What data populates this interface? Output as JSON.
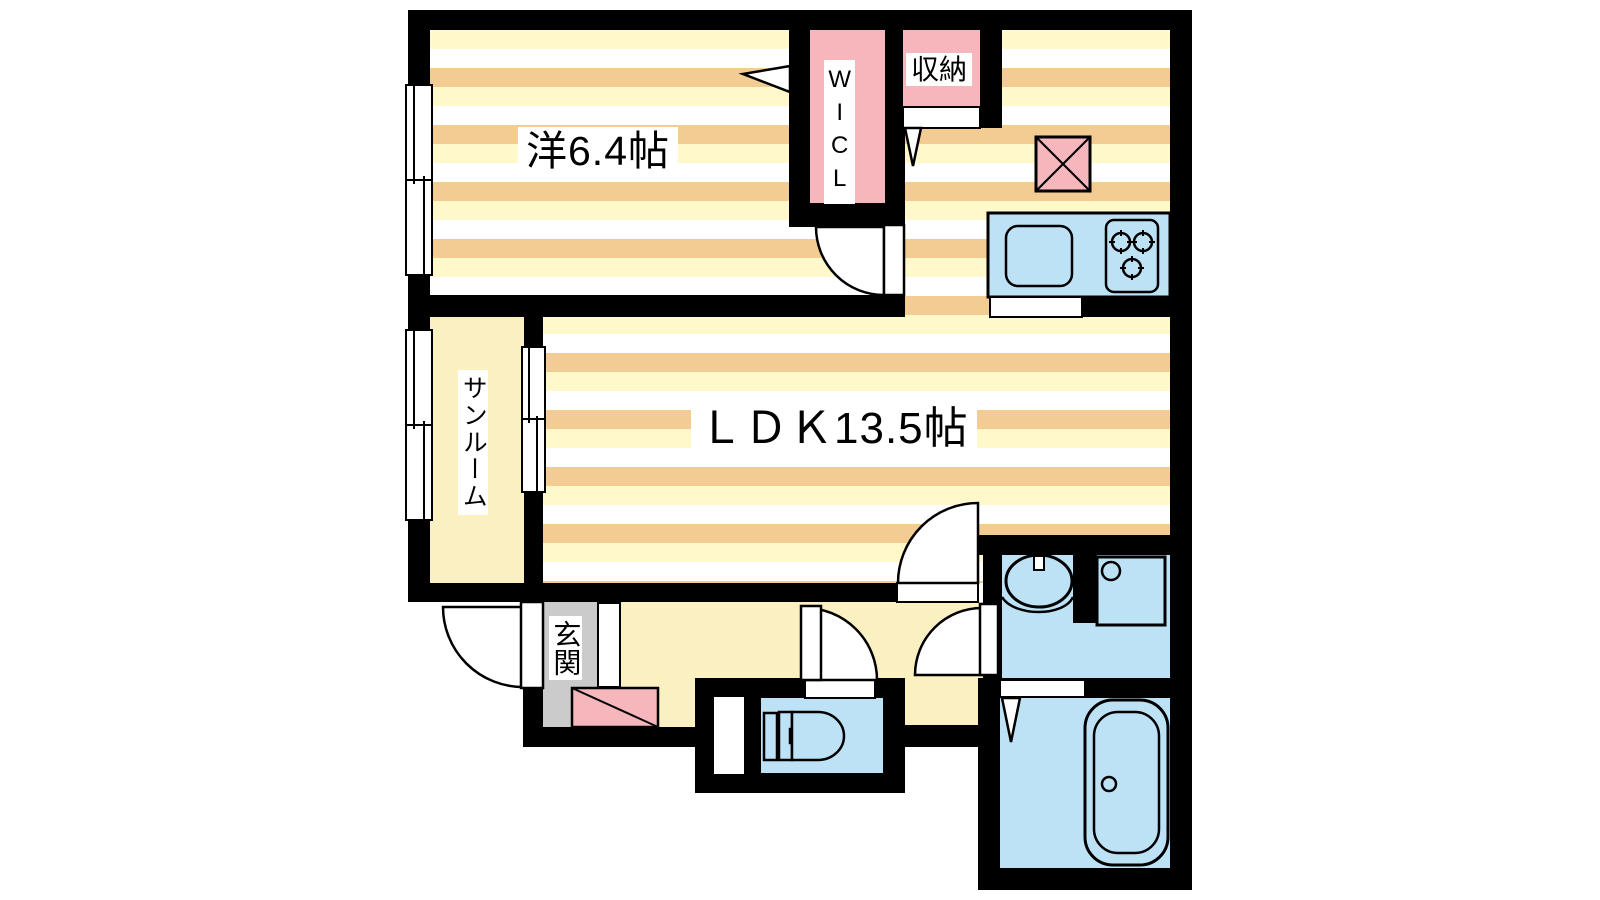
{
  "floorplan": {
    "rooms": {
      "western_room": "洋6.4帖",
      "ldk": "ＬＤＫ13.5帖",
      "wicl": "WICL",
      "storage": "収納",
      "sunroom": "サンルーム",
      "entrance": "玄関"
    },
    "colors": {
      "wall": "#000000",
      "stripe_orange": "#F2CC92",
      "stripe_yellow": "#FFF8CB",
      "plain_floor": "#FAF0C1",
      "closet_pink": "#F5B6BC",
      "fixture_blue": "#BEE2F5",
      "entrance_gray": "#CBCBCB"
    }
  }
}
